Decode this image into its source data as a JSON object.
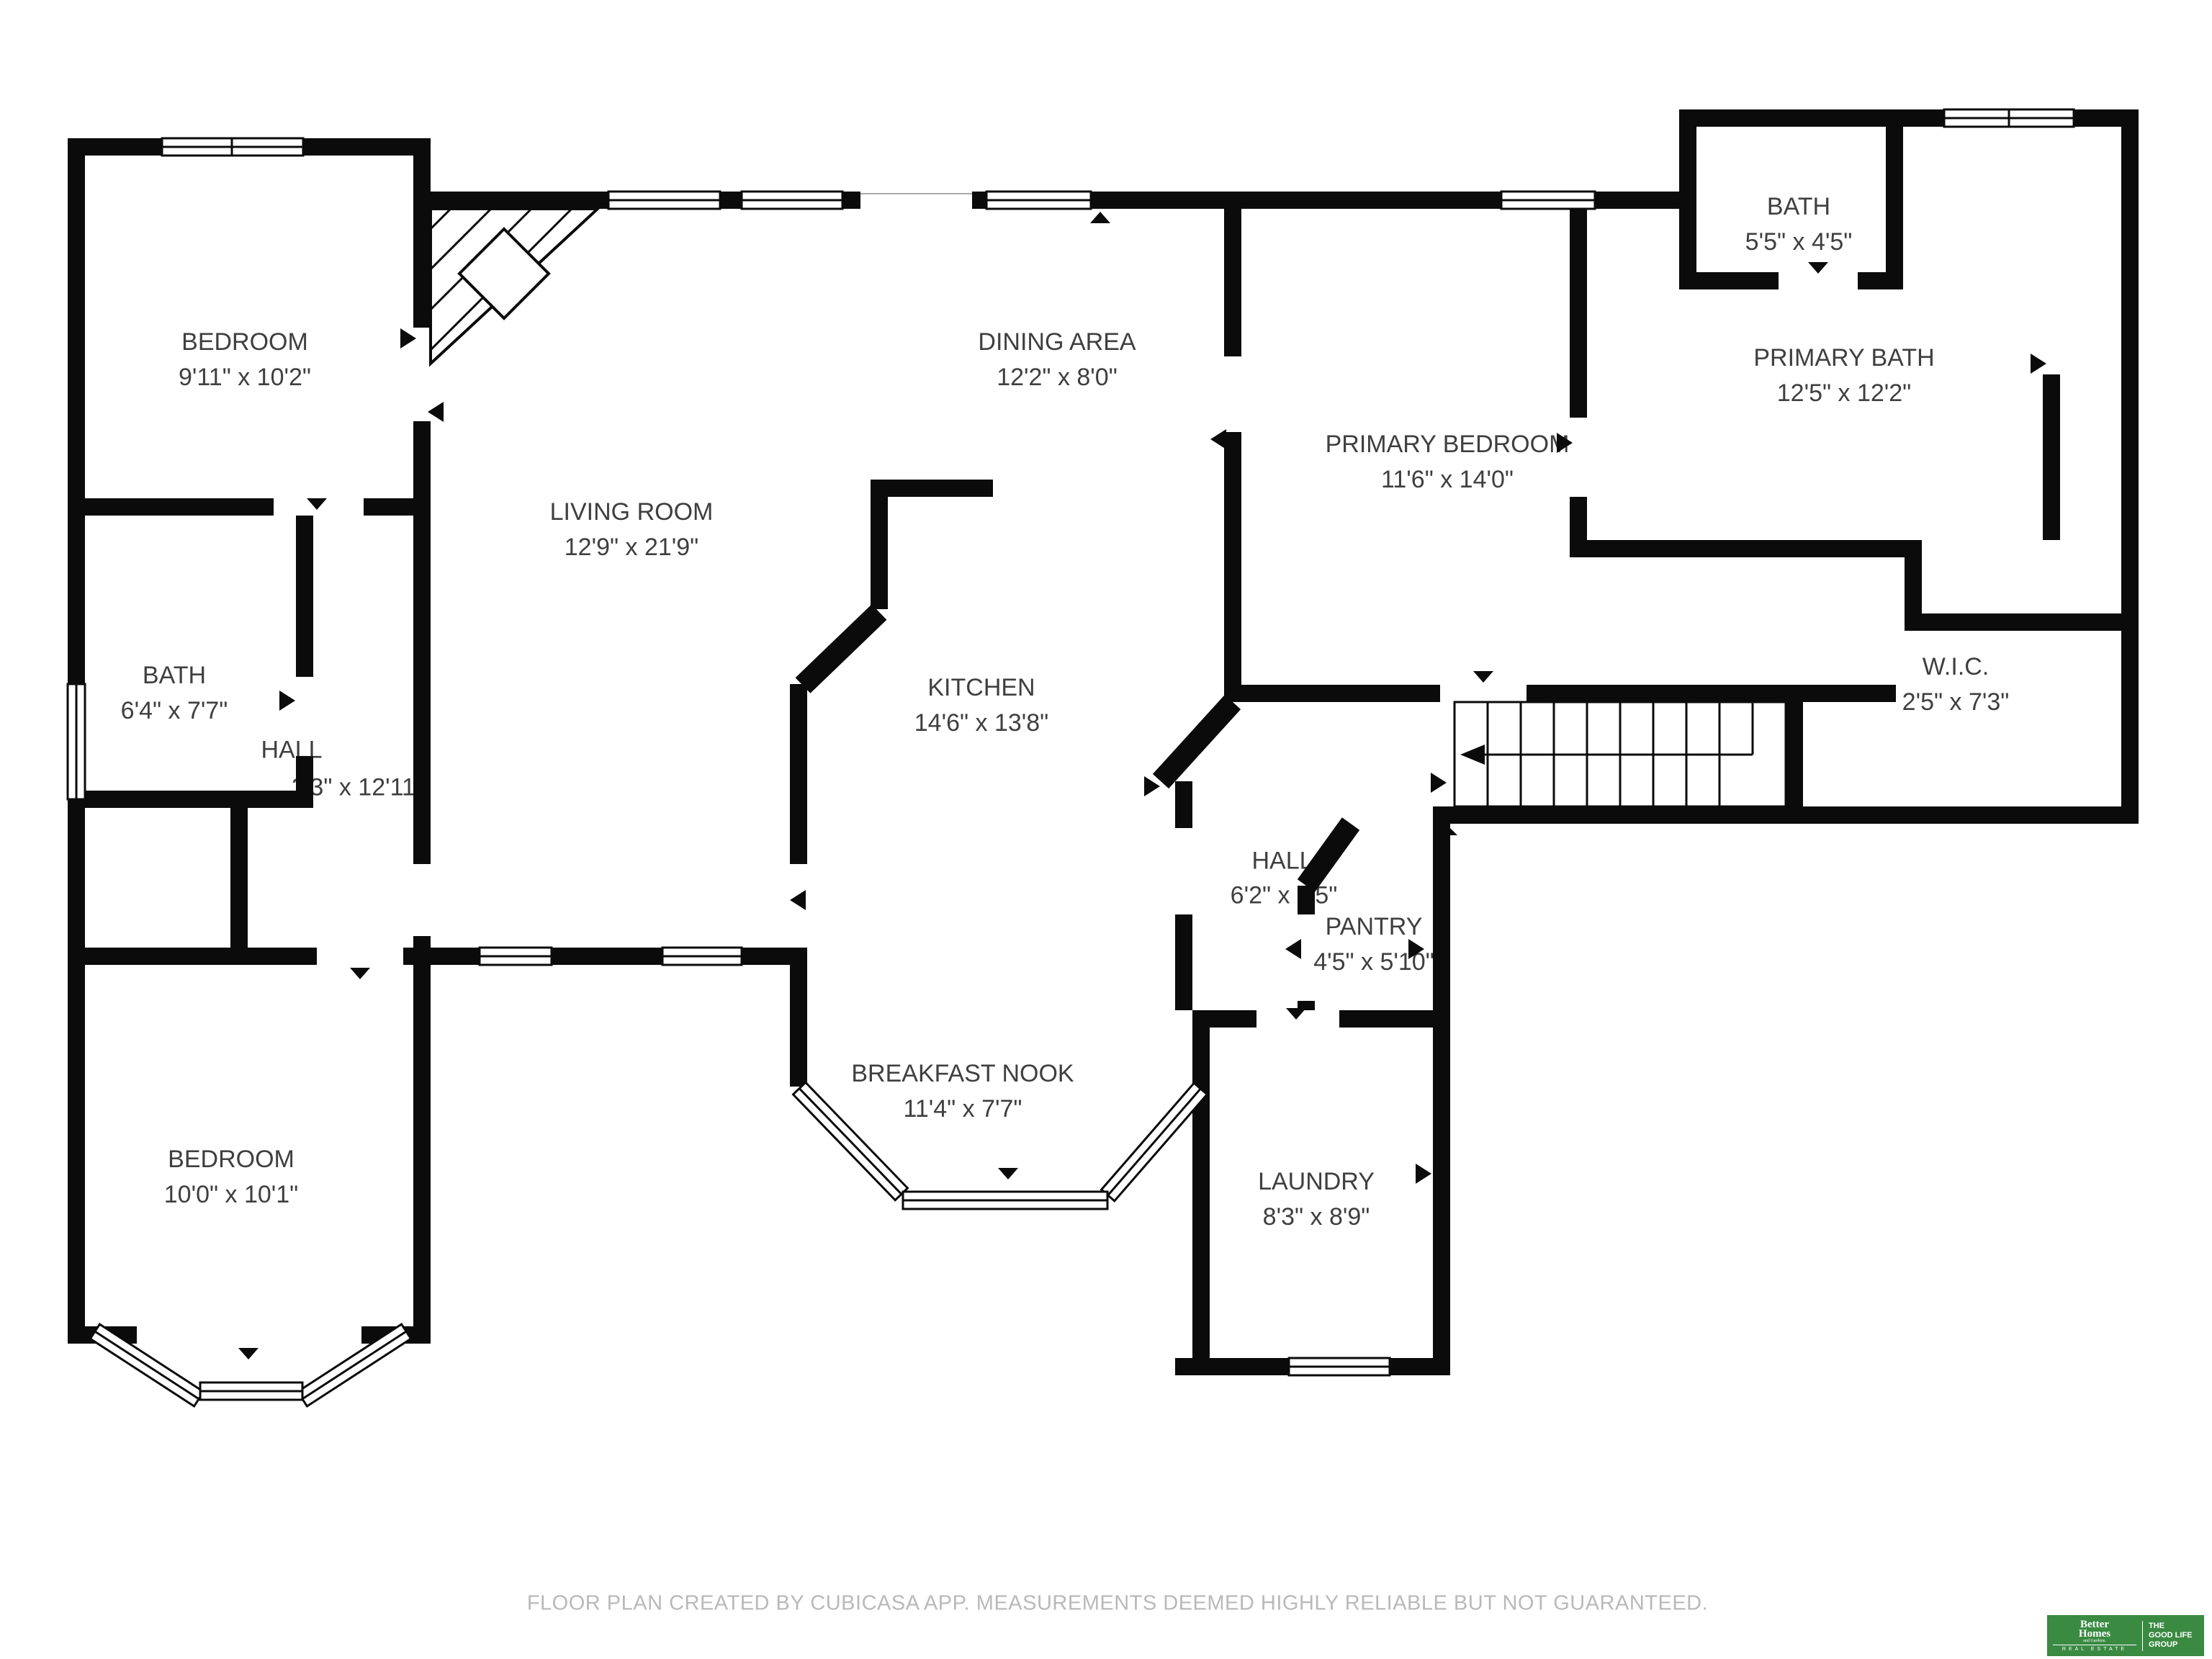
{
  "rooms": {
    "bedroom1": {
      "name": "BEDROOM",
      "dims": "9'11\" x 10'2\""
    },
    "dining": {
      "name": "DINING AREA",
      "dims": "12'2\" x 8'0\""
    },
    "bath_top": {
      "name": "BATH",
      "dims": "5'5\" x 4'5\""
    },
    "primary_bath": {
      "name": "PRIMARY BATH",
      "dims": "12'5\" x 12'2\""
    },
    "primary_bedroom": {
      "name": "PRIMARY BEDROOM",
      "dims": "11'6\" x 14'0\""
    },
    "living": {
      "name": "LIVING ROOM",
      "dims": "12'9\" x 21'9\""
    },
    "bath_left": {
      "name": "BATH",
      "dims": "6'4\" x 7'7\""
    },
    "hall_left": {
      "name": "HALL",
      "dims": "3'3\" x 12'11\""
    },
    "kitchen": {
      "name": "KITCHEN",
      "dims": "14'6\" x 13'8\""
    },
    "wic": {
      "name": "W.I.C.",
      "dims": "2'5\" x 7'3\""
    },
    "hall_right": {
      "name": "HALL",
      "dims": "6'2\" x 9'5\""
    },
    "pantry": {
      "name": "PANTRY",
      "dims": "4'5\" x 5'10\""
    },
    "breakfast_nook": {
      "name": "BREAKFAST NOOK",
      "dims": "11'4\" x 7'7\""
    },
    "bedroom2": {
      "name": "BEDROOM",
      "dims": "10'0\" x 10'1\""
    },
    "laundry": {
      "name": "LAUNDRY",
      "dims": "8'3\" x 8'9\""
    }
  },
  "footer": {
    "disclaimer": "FLOOR PLAN CREATED BY CUBICASA APP. MEASUREMENTS DEEMED HIGHLY RELIABLE BUT NOT GUARANTEED."
  },
  "logo": {
    "brand_top": "Better",
    "brand_mid": "Homes",
    "brand_sub": "and Gardens.",
    "brand_bottom": "REAL ESTATE",
    "right_line1": "THE",
    "right_line2": "GOOD LIFE",
    "right_line3": "GROUP",
    "green": "#3a8a42"
  },
  "colors": {
    "wall": "#0b0b0b",
    "label_text": "#3f3f3f",
    "footer_text": "#b9b9b9"
  }
}
